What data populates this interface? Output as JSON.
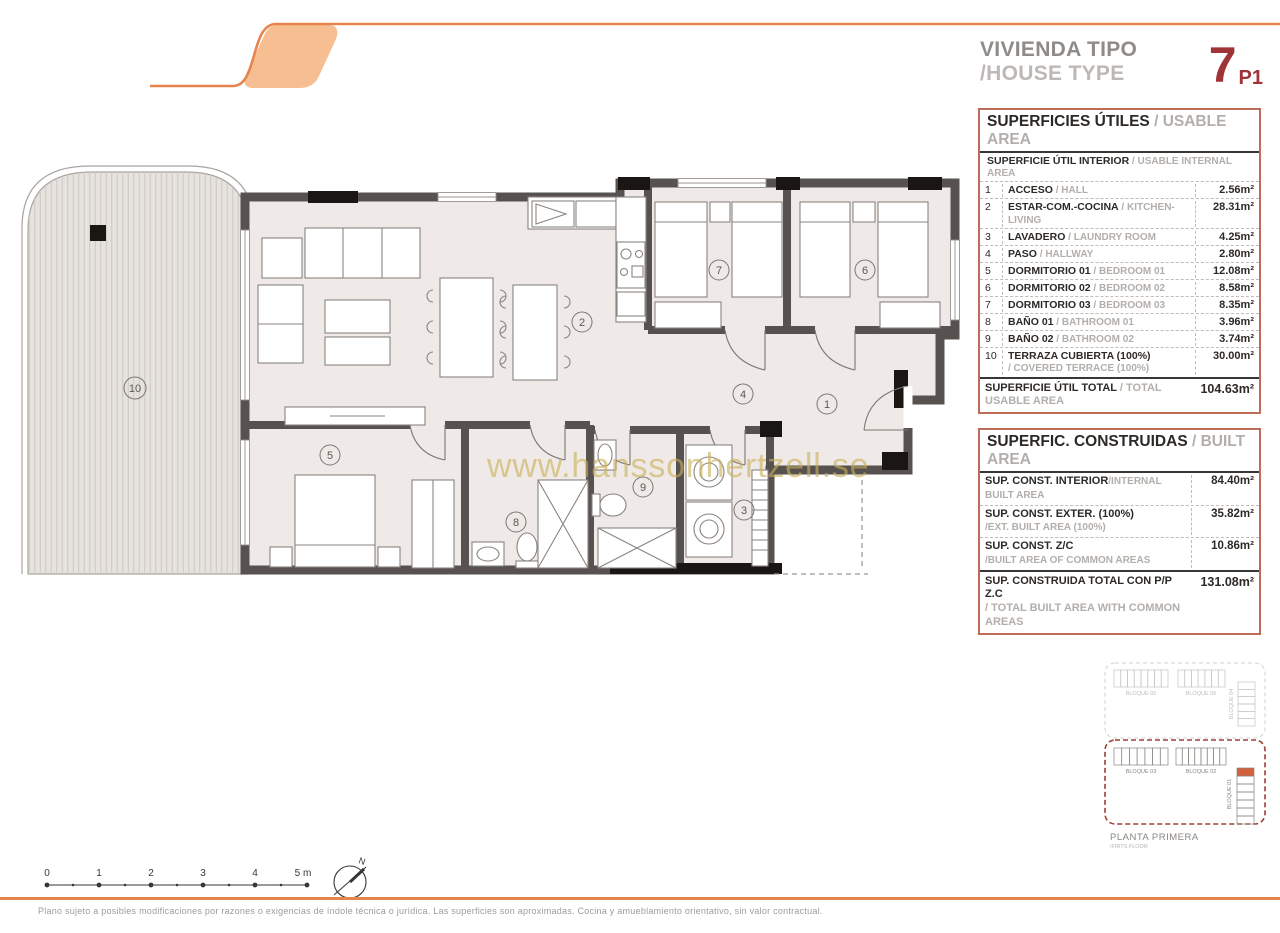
{
  "header": {
    "title_es": "VIVIENDA TIPO",
    "title_en": "/HOUSE TYPE",
    "type_number": "7",
    "type_sub": "P1"
  },
  "usable_table": {
    "title_es": "SUPERFICIES ÚTILES",
    "title_en": " / USABLE AREA",
    "subtitle_es": "SUPERFICIE ÚTIL INTERIOR",
    "subtitle_en": " / USABLE INTERNAL AREA",
    "rows": [
      {
        "num": "1",
        "es": "ACCESO",
        "en": " / HALL",
        "area": "2.56m²"
      },
      {
        "num": "2",
        "es": "ESTAR-COM.-COCINA",
        "en": " / KITCHEN-LIVING",
        "area": "28.31m²"
      },
      {
        "num": "3",
        "es": "LAVADERO",
        "en": " / LAUNDRY ROOM",
        "area": "4.25m²"
      },
      {
        "num": "4",
        "es": "PASO",
        "en": " / HALLWAY",
        "area": "2.80m²"
      },
      {
        "num": "5",
        "es": "DORMITORIO 01",
        "en": " / BEDROOM 01",
        "area": "12.08m²"
      },
      {
        "num": "6",
        "es": "DORMITORIO 02",
        "en": " / BEDROOM 02",
        "area": "8.58m²"
      },
      {
        "num": "7",
        "es": "DORMITORIO 03",
        "en": " / BEDROOM 03",
        "area": "8.35m²"
      },
      {
        "num": "8",
        "es": "BAÑO 01",
        "en": " / BATHROOM 01",
        "area": "3.96m²"
      },
      {
        "num": "9",
        "es": "BAÑO 02",
        "en": " / BATHROOM 02",
        "area": "3.74m²"
      },
      {
        "num": "10",
        "es": "TERRAZA CUBIERTA (100%)",
        "en": "/ COVERED TERRACE (100%)",
        "area": "30.00m²",
        "two_line": true
      }
    ],
    "total_es": "SUPERFICIE ÚTIL TOTAL",
    "total_en": " / TOTAL USABLE AREA",
    "total_area": "104.63m²"
  },
  "built_table": {
    "title_es": "SUPERFIC. CONSTRUIDAS",
    "title_en": " / BUILT AREA",
    "rows": [
      {
        "es": "SUP. CONST. INTERIOR",
        "en": "/INTERNAL BUILT AREA",
        "area": "84.40m²",
        "two_line": false
      },
      {
        "es": "SUP. CONST. EXTER. (100%)",
        "en": "/EXT. BUILT AREA (100%)",
        "area": "35.82m²",
        "two_line": true
      },
      {
        "es": "SUP. CONST. Z/C",
        "en": "/BUILT AREA OF COMMON AREAS",
        "area": "10.86m²",
        "two_line": true
      }
    ],
    "total_es": "SUP. CONSTRUIDA TOTAL CON P/P Z.C",
    "total_en": "/ TOTAL BUILT AREA WITH COMMON AREAS",
    "total_area": "131.08m²"
  },
  "plan": {
    "watermark": "www.hanssonhertzell.se",
    "rooms": [
      {
        "num": "1"
      },
      {
        "num": "2"
      },
      {
        "num": "3"
      },
      {
        "num": "4"
      },
      {
        "num": "5"
      },
      {
        "num": "6"
      },
      {
        "num": "7"
      },
      {
        "num": "8"
      },
      {
        "num": "9"
      },
      {
        "num": "10"
      }
    ]
  },
  "site_plan": {
    "block05": "BLOQUE 05",
    "block06": "BLOQUE 06",
    "block04": "BLOQUE 04",
    "block03": "BLOQUE 03",
    "block02": "BLOQUE 02",
    "block01": "BLOQUE 01",
    "floor_es": "PLANTA PRIMERA",
    "floor_en": "/FIRTS FLOOR",
    "highlight_color": "#d2603a"
  },
  "scale_bar": {
    "labels": [
      "0",
      "1",
      "2",
      "3",
      "4",
      "5 m"
    ],
    "north": "N"
  },
  "footer": {
    "disclaimer": "Plano sujeto a posibles modificaciones por razones o exigencias de índole técnica o jurídica. Las superficies son aproximadas. Cocina y amueblamiento orientativo, sin valor contractual."
  },
  "colors": {
    "accent_orange": "#e5854d",
    "logo_fill": "#f7be92",
    "type_red": "#9e3338",
    "table_border": "#c06b55",
    "wall": "#575150",
    "floor": "#efe9e7",
    "terrace": "#e6e2de"
  }
}
